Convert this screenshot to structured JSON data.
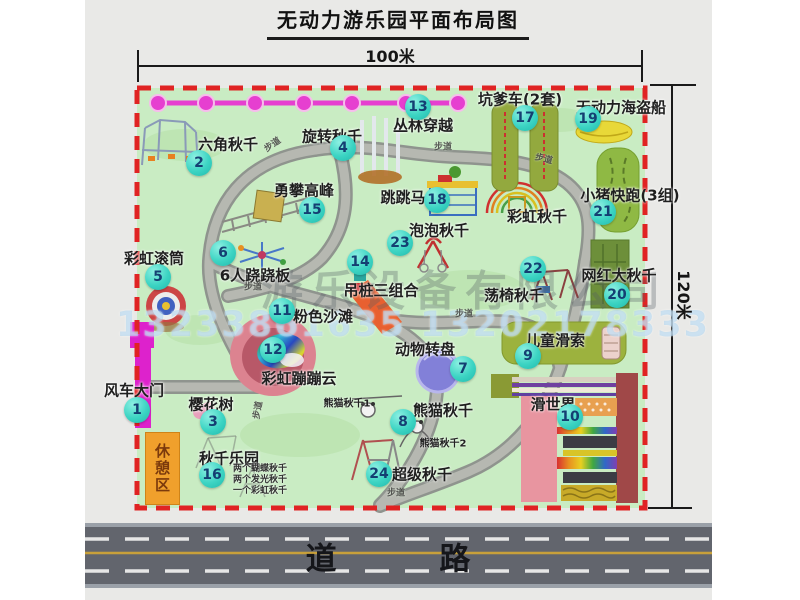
{
  "title": "无动力游乐园平面布局图",
  "dims": {
    "width": "100米",
    "height": "120米"
  },
  "road": {
    "label": "道 路"
  },
  "watermark": {
    "company": "游乐设备有限公司",
    "phone": "13233861635 13202178333"
  },
  "path_label": "步道",
  "colors": {
    "badge": "#3cd4c3",
    "border_red": "#e02323",
    "park_green": "#c9ecc3",
    "gate_magenta": "#dd22cc",
    "rest_orange": "#f0a02c",
    "road_gray": "#62656d"
  },
  "attractions": [
    {
      "num": "1",
      "label": "风车大门"
    },
    {
      "num": "2",
      "label": "六角秋千"
    },
    {
      "num": "3",
      "label": "樱花树"
    },
    {
      "num": "4",
      "label": "旋转秋千"
    },
    {
      "num": "5",
      "label": "彩虹滚筒"
    },
    {
      "num": "6",
      "label": "6人跷跷板"
    },
    {
      "num": "7",
      "label": "动物转盘"
    },
    {
      "num": "8",
      "label": "熊猫秋千"
    },
    {
      "num": "9",
      "label": "儿童滑索"
    },
    {
      "num": "10",
      "label": "滑世界"
    },
    {
      "num": "11",
      "label": "粉色沙滩"
    },
    {
      "num": "12",
      "label": "彩虹蹦蹦云"
    },
    {
      "num": "13",
      "label": "丛林穿越"
    },
    {
      "num": "14",
      "label": "吊桩三组合"
    },
    {
      "num": "15",
      "label": "勇攀高峰"
    },
    {
      "num": "16",
      "label": "秋千乐园"
    },
    {
      "num": "17",
      "label": "坑爹车(2套)"
    },
    {
      "num": "18",
      "label": "跳跳马"
    },
    {
      "num": "19",
      "label": "无动力海盗船"
    },
    {
      "num": "20",
      "label": "网红大秋千"
    },
    {
      "num": "21",
      "label": "小猪快跑(3组)"
    },
    {
      "num": "22",
      "label": "荡椅秋千"
    },
    {
      "num": "23",
      "label": "泡泡秋千"
    },
    {
      "num": "24",
      "label": "超级秋千"
    }
  ],
  "extras": {
    "rainbow_swing": "彩虹秋千",
    "rest_area": "休憩区",
    "panda_swing_1": "熊猫秋千1",
    "panda_swing_2": "熊猫秋千2",
    "swing_note_1": "两个蝴蝶秋千",
    "swing_note_2": "两个发光秋千",
    "swing_note_3": "一个彩虹秋千"
  }
}
